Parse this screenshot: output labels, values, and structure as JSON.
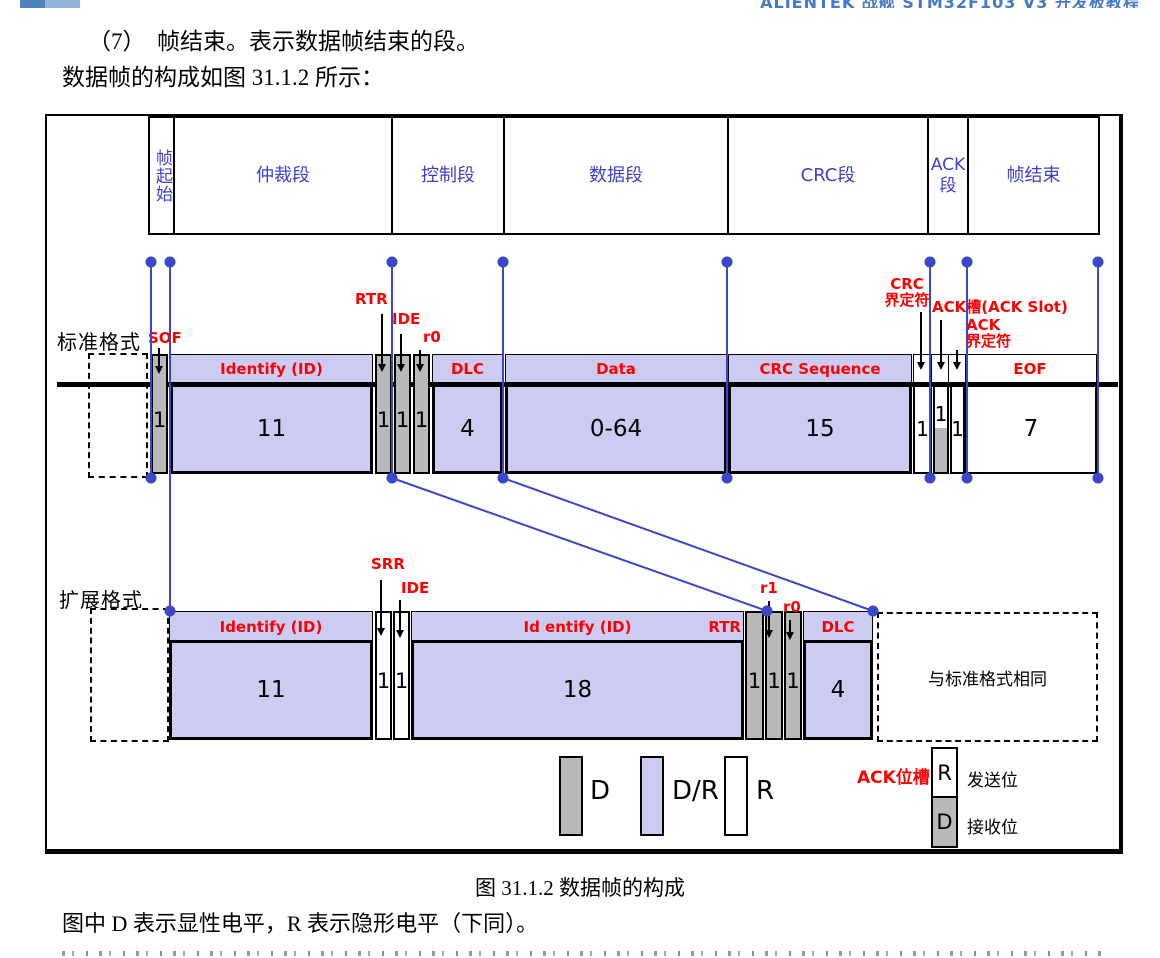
{
  "colors": {
    "accent_blue": "#3c46c8",
    "segment_text_blue": "#4040cc",
    "label_red": "#fe0000",
    "fill_purple": "#ccccf2",
    "fill_gray": "#b9b9b9",
    "header_blue": "#4478c8",
    "logo_dark": "#4f81bd",
    "logo_light": "#95b3d7"
  },
  "header": {
    "title": "ALIENTEK 战舰 STM32F103 V3 开发板教程"
  },
  "intro": {
    "line1": "（7）　帧结束。表示数据帧结束的段。",
    "line2": "数据帧的构成如图 31.1.2 所示："
  },
  "figure": {
    "caption": "图 31.1.2 数据帧的构成",
    "note": "图中 D 表示显性电平，R 表示隐形电平（下同）。"
  },
  "diagram": {
    "segments": [
      {
        "label": "帧起始"
      },
      {
        "label": "仲裁段"
      },
      {
        "label": "控制段"
      },
      {
        "label": "数据段"
      },
      {
        "label": "CRC段"
      },
      {
        "label": "ACK段"
      },
      {
        "label": "帧结束"
      }
    ],
    "standard": {
      "row_label": "标准格式",
      "sof": {
        "label": "SOF",
        "bits": "1"
      },
      "id": {
        "label": "Identify (ID)",
        "bits": "11"
      },
      "rtr": {
        "label": "RTR",
        "bits": "1"
      },
      "ide": {
        "label": "IDE",
        "bits": "1"
      },
      "r0": {
        "label": "r0",
        "bits": "1"
      },
      "dlc": {
        "label": "DLC",
        "bits": "4"
      },
      "data": {
        "label": "Data",
        "bits": "0-64"
      },
      "crc": {
        "label": "CRC Sequence",
        "bits": "15"
      },
      "crc_delim": {
        "label_line1": "CRC",
        "label_line2": "界定符",
        "bits": "1"
      },
      "ack_slot": {
        "label": "ACK槽(ACK Slot)",
        "bits": "1"
      },
      "ack_delim": {
        "label_line1": "ACK",
        "label_line2": "界定符",
        "bits": "1"
      },
      "eof": {
        "label": "EOF",
        "bits": "7"
      }
    },
    "extended": {
      "row_label": "扩展格式",
      "id": {
        "label": "Identify (ID)",
        "bits": "11"
      },
      "srr": {
        "label": "SRR",
        "bits": "1"
      },
      "ide": {
        "label": "IDE",
        "bits": "1"
      },
      "id2": {
        "label": "Id entify (ID)",
        "bits": "18"
      },
      "rtr": {
        "label": "RTR",
        "bits": "1"
      },
      "r1": {
        "label": "r1",
        "bits": "1"
      },
      "r0": {
        "label": "r0",
        "bits": "1"
      },
      "dlc": {
        "label": "DLC",
        "bits": "4"
      },
      "same_note": "与标准格式相同"
    },
    "legend": {
      "d": {
        "label": "D"
      },
      "dr": {
        "label": "D/R"
      },
      "r": {
        "label": "R"
      },
      "ack_slot_label": "ACK位槽",
      "send": {
        "bit": "R",
        "label": "发送位"
      },
      "recv": {
        "bit": "D",
        "label": "接收位"
      }
    }
  }
}
